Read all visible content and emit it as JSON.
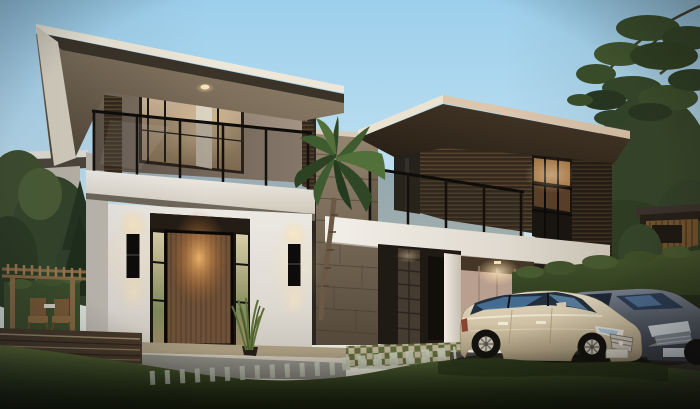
{
  "meta": {
    "title": "Modern two-storey house exterior rendering at dusk",
    "width_px": 700,
    "height_px": 409
  },
  "scene": {
    "description": "Photorealistic architectural rendering: modern flat-roof two-storey house at dusk, interior lights on, glass balcony, wood-slat screened wing over carport, palm tree, hedges, lawn with stepping stones, two luxury sedans parked",
    "objects": [
      "sky",
      "left-wing",
      "left-balcony",
      "entry-door",
      "wall-sconces",
      "stone-core-wall",
      "palm-tree",
      "right-wing",
      "slat-screens",
      "carport-canopy",
      "garage-wall",
      "hedges",
      "pergola-patio",
      "wood-deck",
      "stepping-stones",
      "lawn",
      "champagne-sedan",
      "grey-sedan",
      "background-houses",
      "trees"
    ]
  },
  "palette": {
    "sky_top": "#9ed3ee",
    "sky_horizon": "#e6e4d6",
    "roof_top": "#ece7d8",
    "roof_fascia": "#3b3328",
    "roof_soffit": "#8c7e6a",
    "wall_taupe": "#8f8171",
    "wall_white": "#e8e5df",
    "slab_white": "#efece6",
    "louver_dark": "#241d15",
    "slat_wood": "#3a2e22",
    "slat_wood_light": "#5a4730",
    "curtain": "#c8b294",
    "door_wood": "#6e5138",
    "door_glow": "#f5b268",
    "sconce_black": "#0d0c0a",
    "glass_tint": "#2a3446",
    "stone_tower": "#94856f",
    "garage_wall": "#b89f90",
    "hedge_green": "#3c4e2a",
    "tree_green": "#3a4f2c",
    "tree_dark": "#273722",
    "grass": "#4f5e2c",
    "grass_dark": "#252e15",
    "deck_wood": "#47392a",
    "pergola_wood": "#8a6a44",
    "concrete": "#908f86",
    "stone_path": "#bcc0ae",
    "checker_light": "#b4ab92",
    "checker_green": "#5d6838",
    "driveway": "#4a453e",
    "car1_body": "#cfc2a5",
    "car1_glass": "#24303f",
    "car2_body": "#5f6874",
    "car2_glass": "#2c3e58",
    "chrome": "#c9c2b4"
  }
}
